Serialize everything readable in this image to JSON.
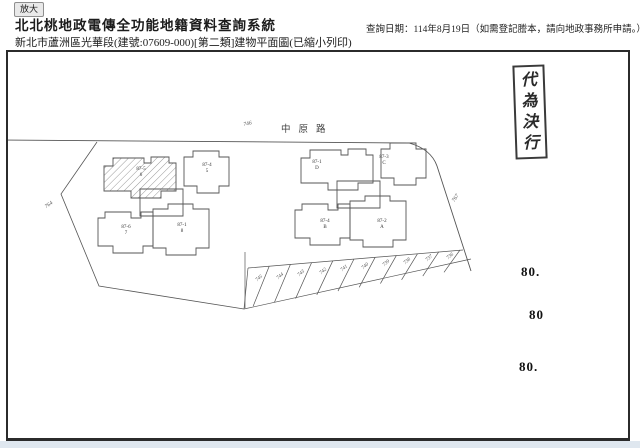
{
  "header": {
    "zoom_button": "放大",
    "title": "北北桃地政電傳全功能地籍資料查詢系統",
    "query_date": "查詢日期：114年8月19日（如需登記謄本，請向地政事務所申請。）",
    "subtitle": "新北市蘆洲區光華段(建號:07609-000)[第二類]建物平面圖(已縮小列印)"
  },
  "plan": {
    "road_name": "中原路",
    "road_lot": "746",
    "left_lot": "764",
    "right_lot": "767",
    "stamp": "代為決行",
    "side_numbers": [
      {
        "text": "80.",
        "x": 513,
        "y": 212
      },
      {
        "text": "80",
        "x": 521,
        "y": 255
      },
      {
        "text": "80.",
        "x": 511,
        "y": 307
      }
    ],
    "buildings": [
      {
        "no": "87-5",
        "unit": "6",
        "x": 133,
        "y": 115,
        "hatched": true
      },
      {
        "no": "87-4",
        "unit": "5",
        "x": 199,
        "y": 111,
        "hatched": false
      },
      {
        "no": "87-6",
        "unit": "7",
        "x": 118,
        "y": 173,
        "hatched": false
      },
      {
        "no": "87-1",
        "unit": "8",
        "x": 174,
        "y": 171,
        "hatched": false
      },
      {
        "no": "87-1",
        "unit": "D",
        "x": 309,
        "y": 108,
        "hatched": false
      },
      {
        "no": "87-3",
        "unit": "C",
        "x": 376,
        "y": 103,
        "hatched": false
      },
      {
        "no": "87-4",
        "unit": "B",
        "x": 317,
        "y": 167,
        "hatched": false
      },
      {
        "no": "87-2",
        "unit": "A",
        "x": 374,
        "y": 167,
        "hatched": false
      }
    ],
    "parcels": [
      "745",
      "744",
      "743",
      "742",
      "741",
      "740",
      "739",
      "738",
      "737",
      "736"
    ]
  }
}
